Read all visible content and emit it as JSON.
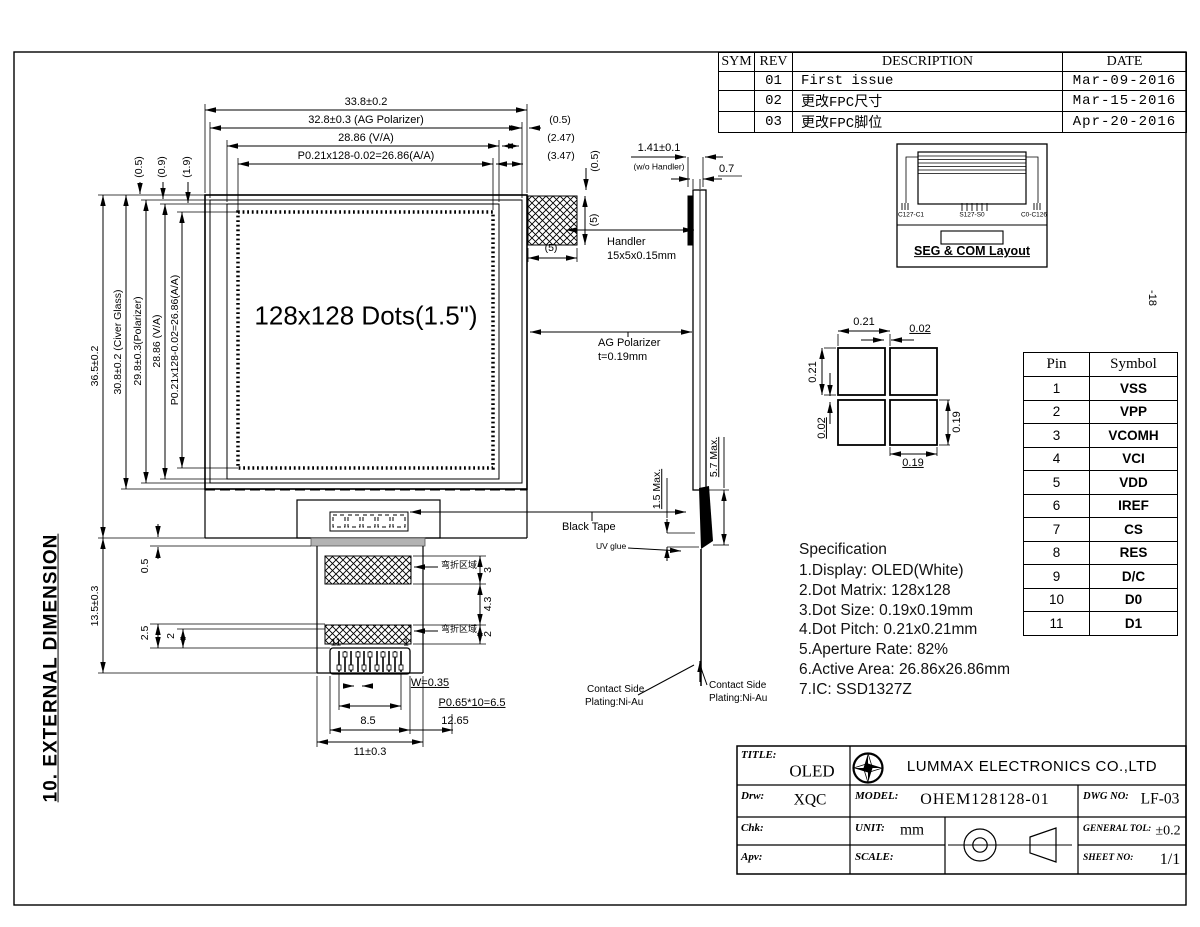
{
  "sheet": {
    "side_note": "-18",
    "section_title": "10. EXTERNAL DIMENSION"
  },
  "revision_table": {
    "headers": [
      "SYM",
      "REV",
      "DESCRIPTION",
      "DATE"
    ],
    "rows": [
      [
        "",
        "01",
        "First issue",
        "Mar-09-2016"
      ],
      [
        "",
        "02",
        "更改FPC尺寸",
        "Mar-15-2016"
      ],
      [
        "",
        "03",
        "更改FPC脚位",
        "Apr-20-2016"
      ]
    ]
  },
  "front_view": {
    "display_label": "128x128 Dots(1.5\")",
    "dim_total_w": "33.8±0.2",
    "dim_polarizer_w": "32.8±0.3 (AG Polarizer)",
    "dim_va_w": "28.86 (V/A)",
    "dim_aa_w": "P0.21x128-0.02=26.86(A/A)",
    "dim_right_05": "(0.5)",
    "dim_right_247": "(2.47)",
    "dim_right_347": "(3.47)",
    "dim_right_05v": "(0.5)",
    "dim_tl_05": "(0.5)",
    "dim_tl_09": "(0.9)",
    "dim_tl_19": "(1.9)",
    "dim_total_h": "36.5±0.2",
    "dim_glass_h": "30.8±0.2 (Civer Glass)",
    "dim_pol_h": "29.8±0.3(Polarizer)",
    "dim_va_h": "28.86 (V/A)",
    "dim_aa_h": "P0.21x128-0.02=26.86(A/A)",
    "handler_dim_w": "(5)",
    "handler_dim_h": "(5)",
    "handler_label_1": "Handler",
    "handler_label_2": "15x5x0.15mm",
    "ag_label_1": "AG Polarizer",
    "ag_label_2": "t=0.19mm"
  },
  "side_view": {
    "dim_thickness": "1.41±0.1",
    "dim_thickness_note": "(w/o  Handler)",
    "dim_07": "0.7",
    "dim_15": "1.5 Max.",
    "dim_57": "5.7 Max.",
    "black_tape": "Black Tape",
    "uv_glue": "UV glue",
    "contact_side": "Contact Side",
    "plating": "Plating:Ni-Au"
  },
  "fpc": {
    "dim_05": "0.5",
    "dim_25": "2.5",
    "dim_2l": "2",
    "dim_135": "13.5±0.3",
    "bend_area": "弯折区域",
    "dim_3": "3",
    "dim_43": "4.3",
    "dim_2r": "2",
    "pin_first": "11",
    "pin_last": "1",
    "dim_w035": "W=0.35",
    "dim_pitch": "P0.65*10=6.5",
    "dim_85": "8.5",
    "dim_1265": "12.65",
    "dim_11": "11±0.3"
  },
  "seg_com": {
    "left": "C127-C1",
    "center": "S127-S0",
    "right": "C0-C126",
    "caption": "SEG & COM Layout"
  },
  "dot_detail": {
    "pitch_h": "0.21",
    "gap_h": "0.02",
    "pitch_v": "0.21",
    "gap_v": "0.02",
    "dot_w": "0.19",
    "dot_h": "0.19"
  },
  "pin_table": {
    "headers": [
      "Pin",
      "Symbol"
    ],
    "rows": [
      [
        "1",
        "VSS"
      ],
      [
        "2",
        "VPP"
      ],
      [
        "3",
        "VCOMH"
      ],
      [
        "4",
        "VCI"
      ],
      [
        "5",
        "VDD"
      ],
      [
        "6",
        "IREF"
      ],
      [
        "7",
        "CS"
      ],
      [
        "8",
        "RES"
      ],
      [
        "9",
        "D/C"
      ],
      [
        "10",
        "D0"
      ],
      [
        "11",
        "D1"
      ]
    ]
  },
  "specification": {
    "title": "Specification",
    "items": [
      "1.Display:  OLED(White)",
      "2.Dot Matrix: 128x128",
      "3.Dot Size:  0.19x0.19mm",
      "4.Dot Pitch:  0.21x0.21mm",
      "5.Aperture Rate: 82%",
      "6.Active Area: 26.86x26.86mm",
      "7.IC:  SSD1327Z"
    ]
  },
  "title_block": {
    "title_label": "TITLE:",
    "title_value": "OLED",
    "company": "LUMMAX ELECTRONICS CO.,LTD",
    "drw_label": "Drw:",
    "drw_value": "XQC",
    "model_label": "MODEL:",
    "model_value": "OHEM128128-01",
    "dwg_label": "DWG NO:",
    "dwg_value": "LF-03",
    "chk_label": "Chk:",
    "unit_label": "UNIT:",
    "unit_value": "mm",
    "tol_label": "GENERAL TOL:",
    "tol_value": "±0.2",
    "apv_label": "Apv:",
    "scale_label": "SCALE:",
    "sheet_label": "SHEET NO:",
    "sheet_value": "1/1"
  }
}
